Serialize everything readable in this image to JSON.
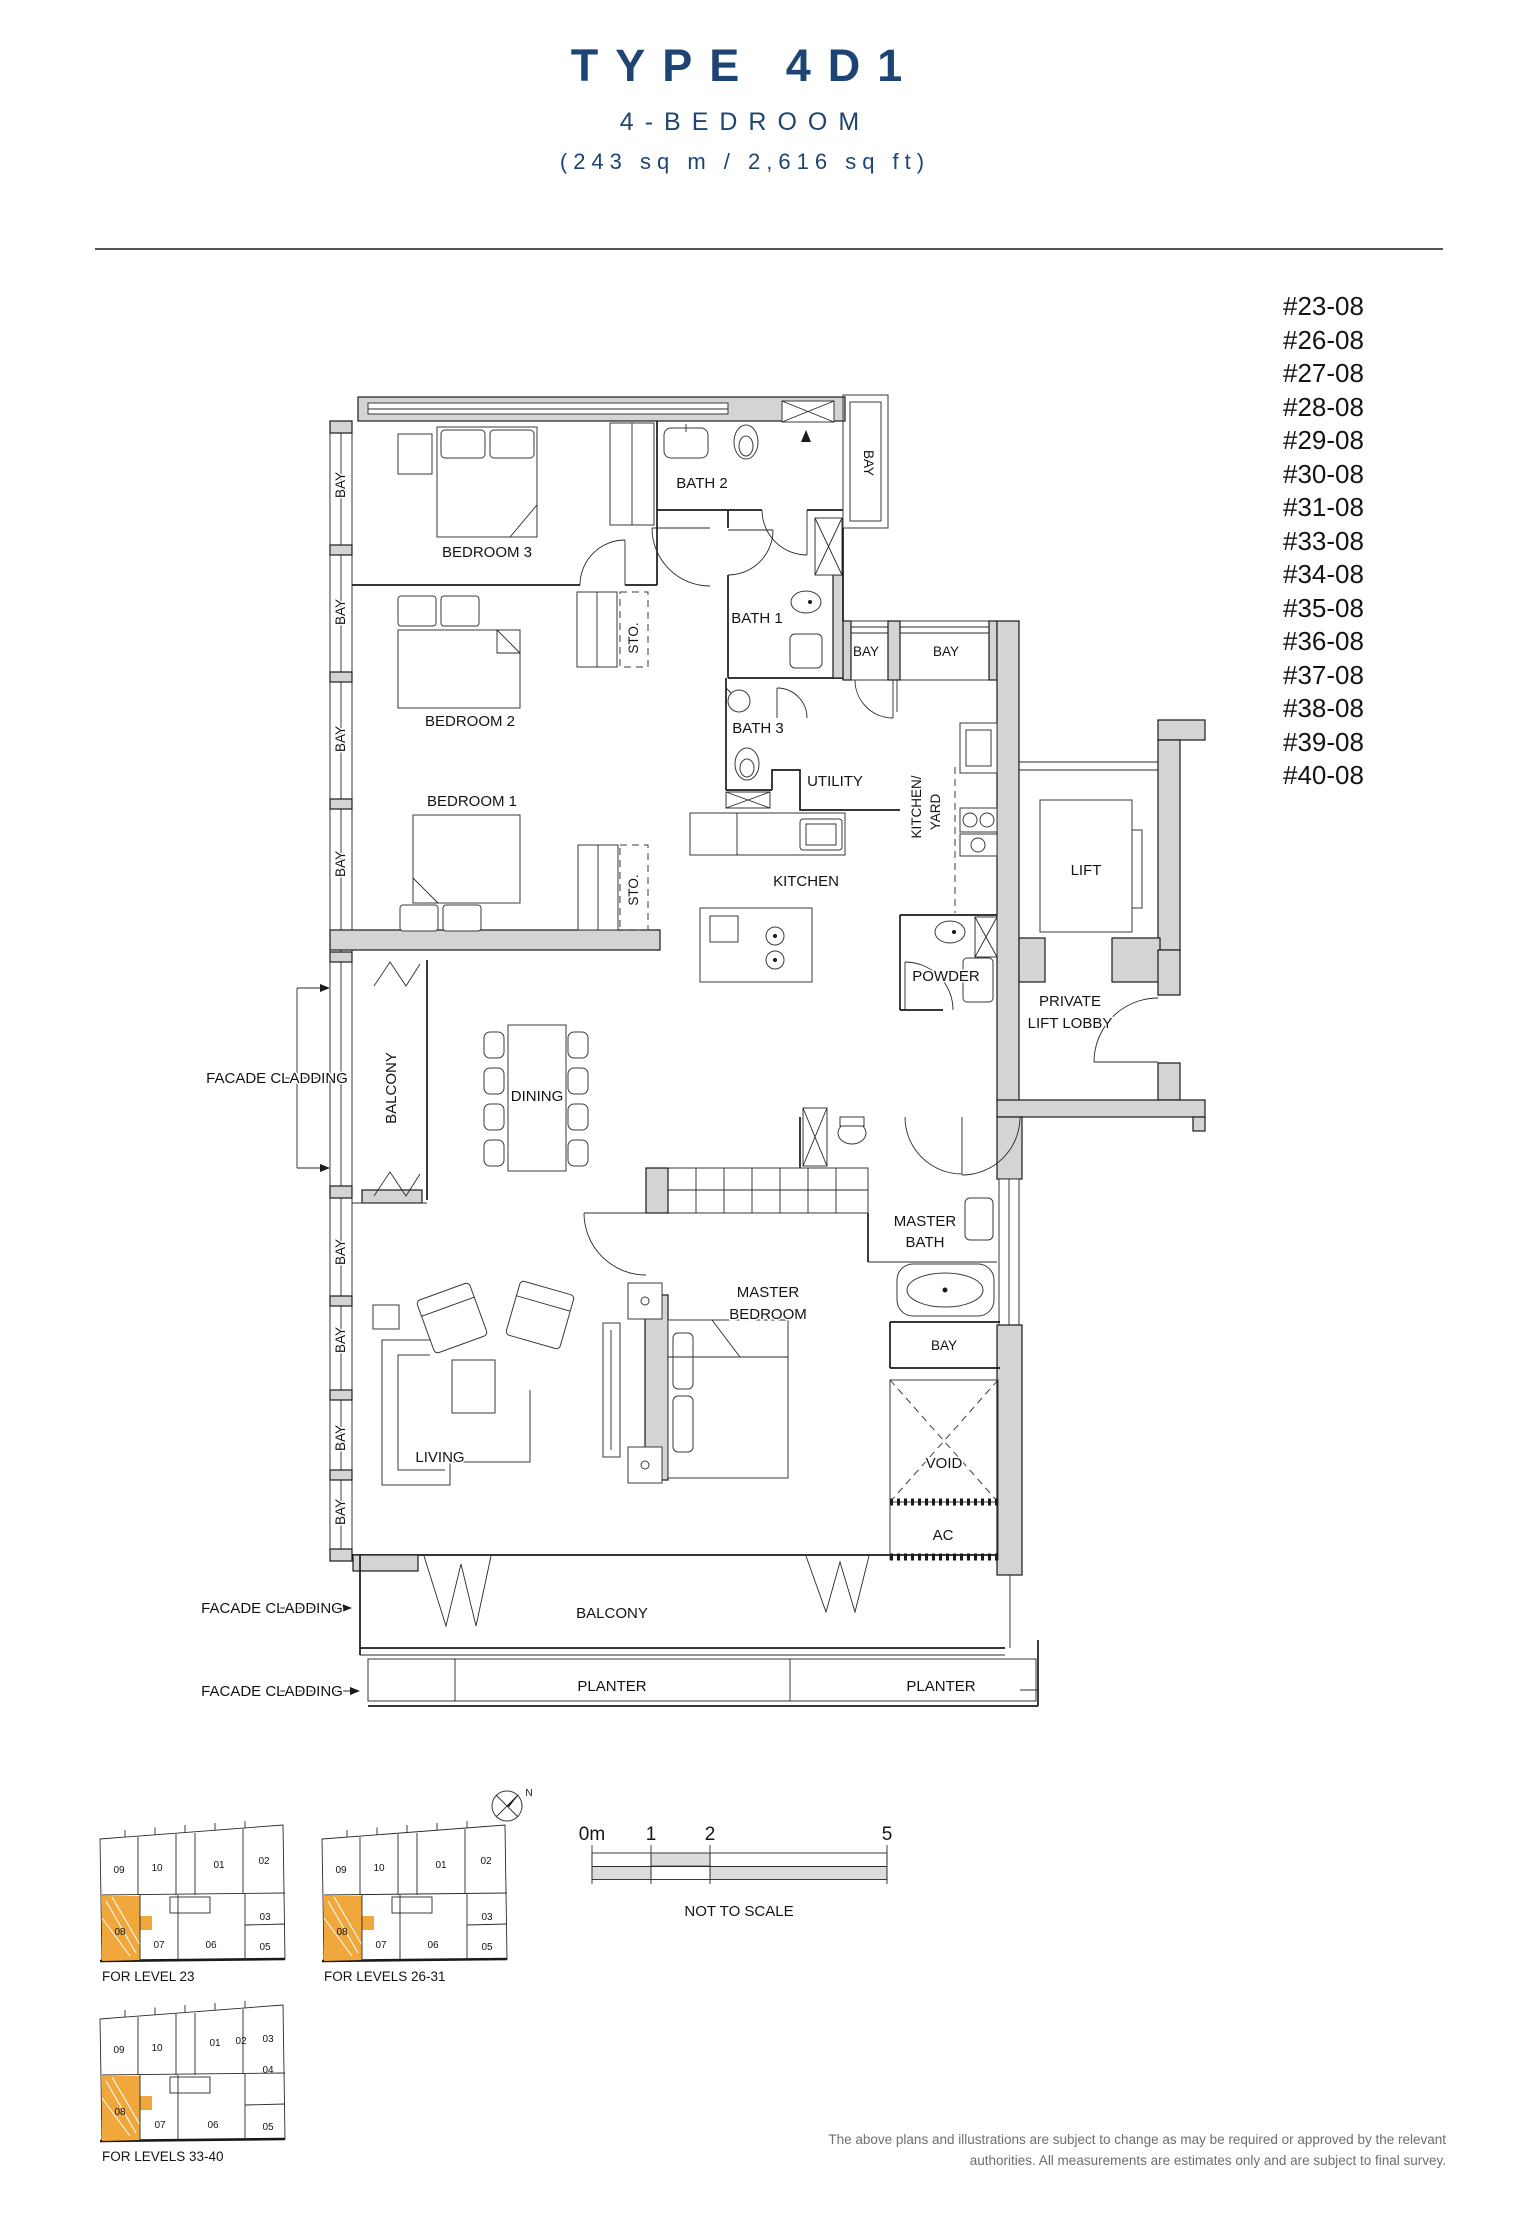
{
  "header": {
    "title": "TYPE 4D1",
    "subtitle": "4-BEDROOM",
    "area": "(243 sq m / 2,616 sq ft)"
  },
  "unit_list": [
    "#23-08",
    "#26-08",
    "#27-08",
    "#28-08",
    "#29-08",
    "#30-08",
    "#31-08",
    "#33-08",
    "#34-08",
    "#35-08",
    "#36-08",
    "#37-08",
    "#38-08",
    "#39-08",
    "#40-08"
  ],
  "plan_labels": {
    "bay": "BAY",
    "bedroom3": "BEDROOM 3",
    "bedroom2": "BEDROOM 2",
    "bedroom1": "BEDROOM 1",
    "bath2": "BATH 2",
    "bath1": "BATH 1",
    "bath3": "BATH 3",
    "sto": "STO.",
    "utility": "UTILITY",
    "kitchen": "KITCHEN",
    "kitchen_yard_line1": "KITCHEN/",
    "kitchen_yard_line2": "YARD",
    "lift": "LIFT",
    "powder": "POWDER",
    "lobby_line1": "PRIVATE",
    "lobby_line2": "LIFT LOBBY",
    "facade_cladding": "FACADE CLADDING",
    "balcony": "BALCONY",
    "dining": "DINING",
    "master": "MASTER",
    "bath": "BATH",
    "bedroom": "BEDROOM",
    "living": "LIVING",
    "void": "VOID",
    "ac": "AC",
    "planter": "PLANTER"
  },
  "key_plans": [
    {
      "caption": "FOR LEVEL 23",
      "units": {
        "u01": "01",
        "u02": "02",
        "u03": "03",
        "u05": "05",
        "u06": "06",
        "u07": "07",
        "u08": "08",
        "u09": "09",
        "u10": "10"
      },
      "highlighted_unit": "08"
    },
    {
      "caption": "FOR LEVELS 26-31",
      "units": {
        "u01": "01",
        "u02": "02",
        "u03": "03",
        "u05": "05",
        "u06": "06",
        "u07": "07",
        "u08": "08",
        "u09": "09",
        "u10": "10"
      },
      "highlighted_unit": "08"
    },
    {
      "caption": "FOR LEVELS 33-40",
      "units": {
        "u01": "01",
        "u02": "02",
        "u03": "03",
        "u04": "04",
        "u05": "05",
        "u06": "06",
        "u07": "07",
        "u08": "08",
        "u09": "09",
        "u10": "10"
      },
      "highlighted_unit": "08"
    }
  ],
  "compass": {
    "label": "N"
  },
  "scale_bar": {
    "ticks": [
      "0m",
      "1",
      "2",
      "5"
    ],
    "note": "NOT TO SCALE"
  },
  "disclaimer": "The above plans and illustrations are subject to change as may be required or approved by the relevant authorities. All measurements are estimates only and are subject to final survey.",
  "colors": {
    "accent_navy": "#1e4473",
    "highlight_orange": "#f0a73c",
    "wall_gray": "#d4d4d4"
  }
}
